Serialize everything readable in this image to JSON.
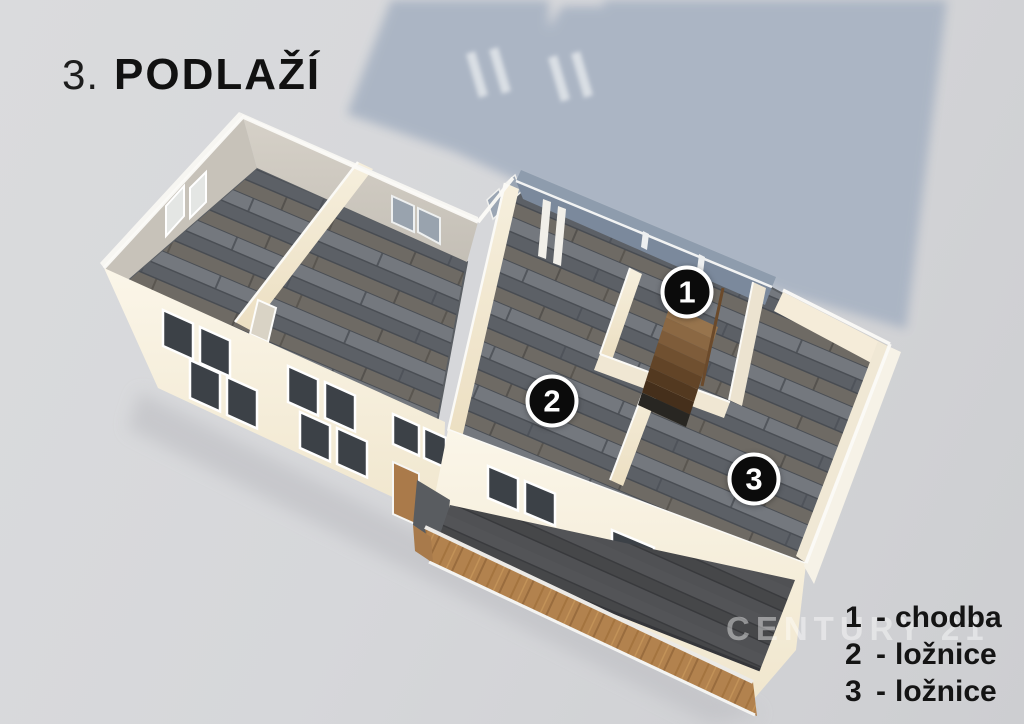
{
  "title": {
    "number": "3.",
    "label": "PODLAŽÍ"
  },
  "floor_plan": {
    "badges": [
      {
        "number": "1"
      },
      {
        "number": "2"
      },
      {
        "number": "3"
      }
    ]
  },
  "legend": {
    "items": [
      {
        "number": "1",
        "separator": "-",
        "label": "chodba"
      },
      {
        "number": "2",
        "separator": "-",
        "label": "ložnice"
      },
      {
        "number": "3",
        "separator": "-",
        "label": "ložnice"
      }
    ]
  },
  "watermark": {
    "text": "CENTURY 21"
  },
  "colors": {
    "background": "#d4d5d8",
    "building_shadow": "#a8b3c3",
    "walls_cream": "#f3ebd9",
    "floor_gray": "#686c72",
    "wood": "#b0824e",
    "badge_background": "#0b0b0b",
    "badge_text": "#ffffff",
    "heading_text": "#1d1d1d",
    "legend_text": "#141414"
  }
}
